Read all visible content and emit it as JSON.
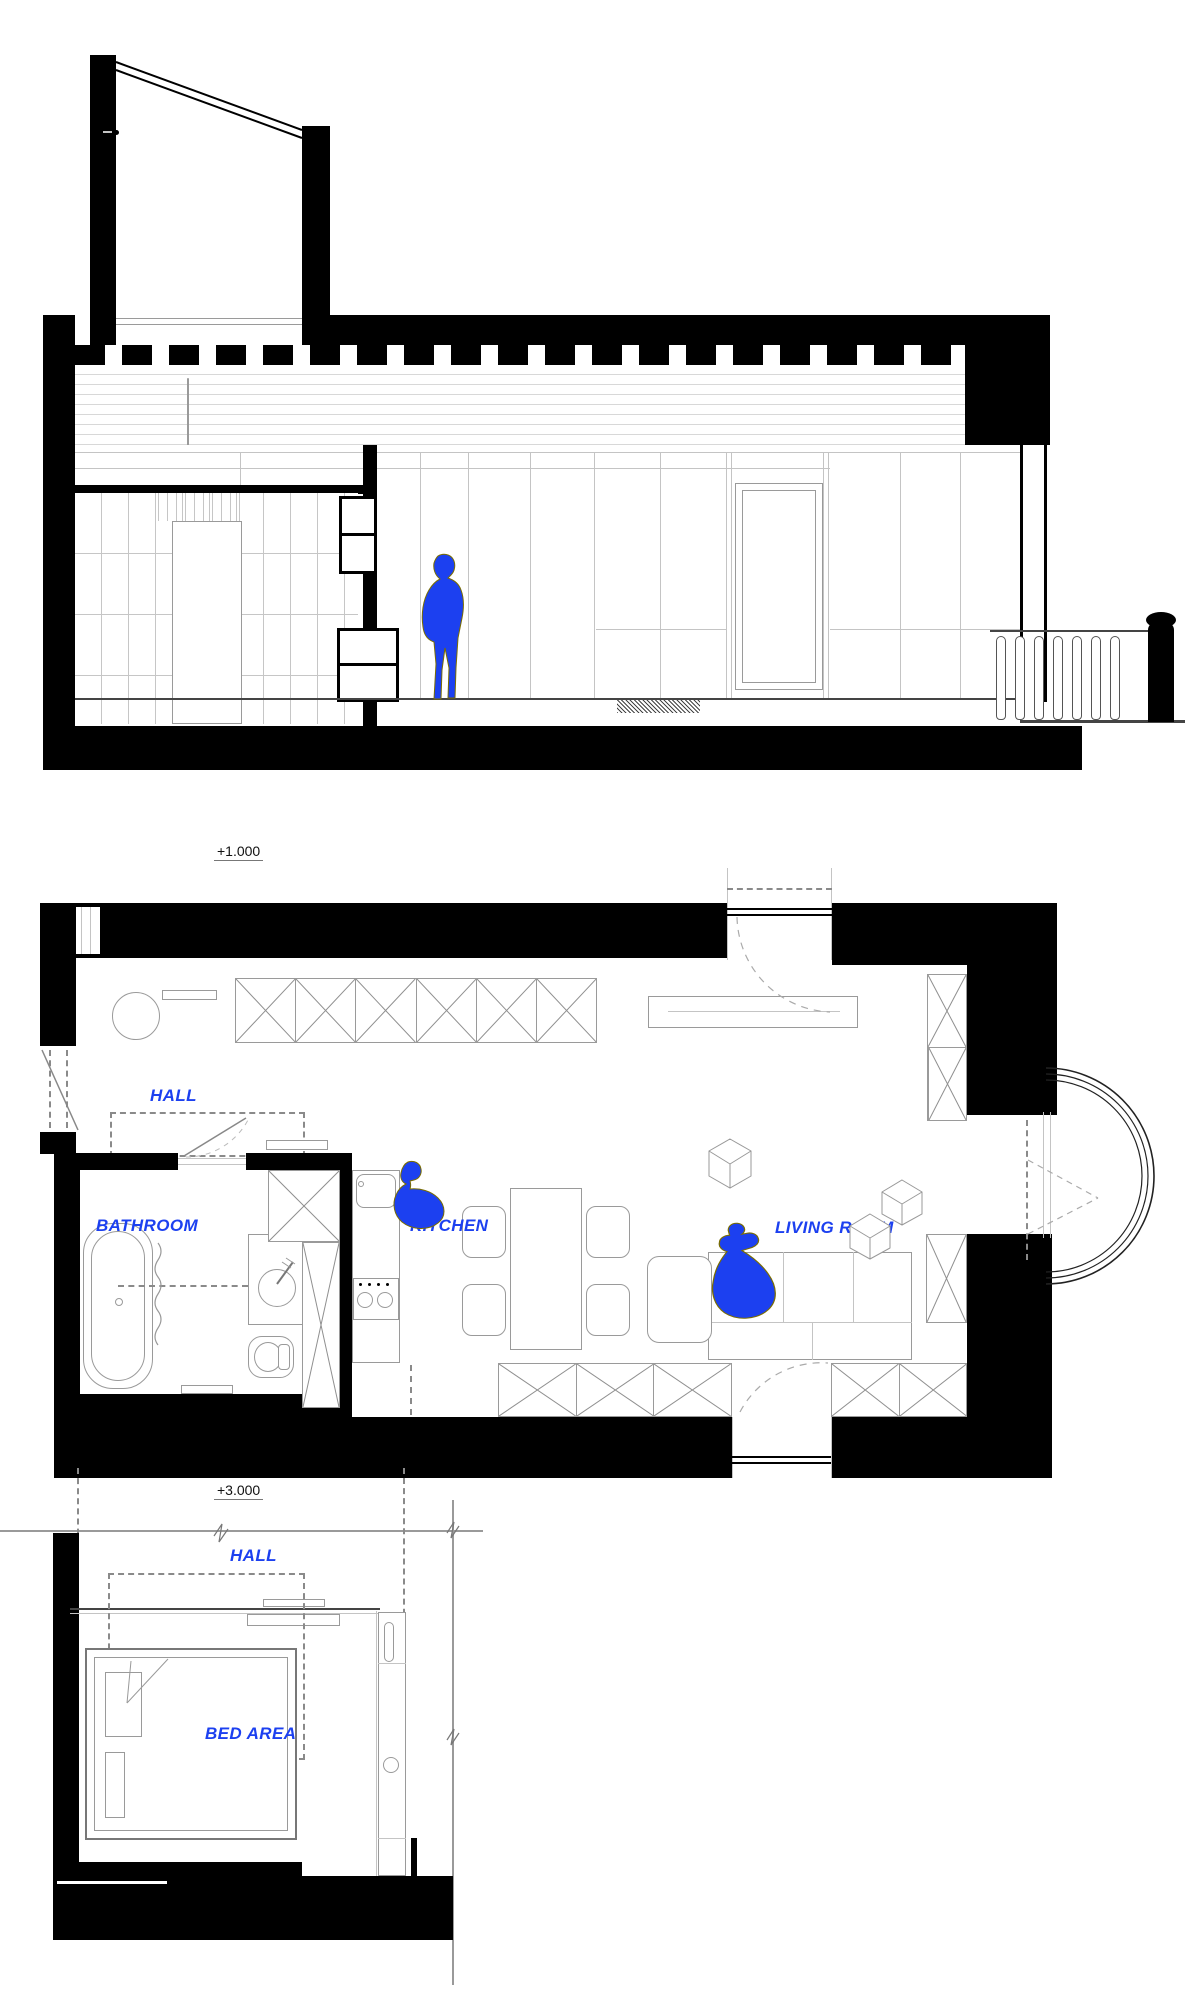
{
  "sheet": {
    "levels": {
      "section_plan_level": "+1.000",
      "mezzanine_plan_level": "+3.000"
    },
    "plan_level_1": {
      "rooms": {
        "hall": "HALL",
        "bathroom": "BATHROOM",
        "kitchen": "KITCHEN",
        "living_room": "LIVING ROOM"
      }
    },
    "plan_level_3": {
      "rooms": {
        "hall": "HALL",
        "bed_area": "BED AREA"
      }
    },
    "colors": {
      "accent_blue": "#1C40F0",
      "wall_black": "#000000",
      "thin_line_gray": "#9A9A9A",
      "dash_gray": "#8A8A8A",
      "brick_joint_gray": "#D8D8D8",
      "figure_outline_olive": "#7A6D00"
    },
    "figures": {
      "section_figure": "standing-person-silhouette",
      "kitchen_figure": "seated-person-top-view",
      "living_room_figure": "reclining-person-top-view"
    }
  }
}
